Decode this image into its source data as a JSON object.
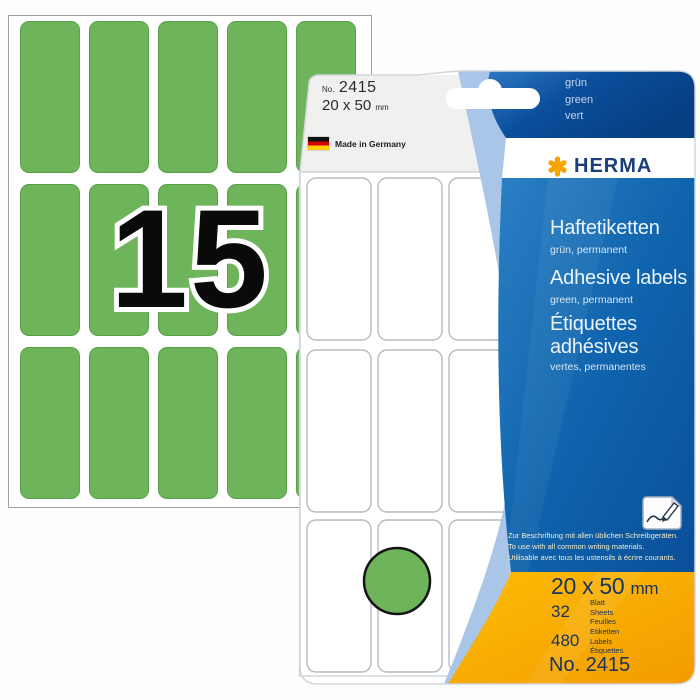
{
  "colors": {
    "label_green": "#6db45a",
    "brand_navy": "#1c3e7d",
    "brand_orange": "#f6a800",
    "panel_blue": "#0f64ad",
    "panel_yellow": "#f8ac00",
    "light_swoosh": "#a9c5e7"
  },
  "sheet": {
    "count": "15",
    "grid": {
      "cols": 5,
      "rows": 3
    }
  },
  "package": {
    "tab": {
      "no_prefix": "No.",
      "number": "2415",
      "size": "20 x 50",
      "size_unit": "mm"
    },
    "origin_label": "Made in Germany",
    "color_names": [
      "grün",
      "green",
      "vert"
    ],
    "brand": "HERMA",
    "products": {
      "de": {
        "title": "Haftetiketten",
        "subtitle": "grün, permanent"
      },
      "en": {
        "title": "Adhesive labels",
        "subtitle": "green, permanent"
      },
      "fr": {
        "title_line1": "Étiquettes",
        "title_line2": "adhésives",
        "subtitle": "vertes, permanentes"
      }
    },
    "usage_notes": [
      "Zur Beschriftung mit allen üblichen Schreibgeräten.",
      "To use with all common writing materials.",
      "Utilisable avec tous les ustensils à écrire courants."
    ],
    "specs": {
      "size": "20 x 50",
      "size_unit": "mm",
      "sheets": {
        "value": "32",
        "words": [
          "Blatt",
          "Sheets",
          "Feuilles"
        ]
      },
      "labels": {
        "value": "480",
        "words": [
          "Etiketten",
          "Labels",
          "Étiquettes"
        ]
      },
      "order_no": "No. 2415"
    },
    "preview": {
      "grid": {
        "cols": 3,
        "rows": 3
      }
    }
  }
}
